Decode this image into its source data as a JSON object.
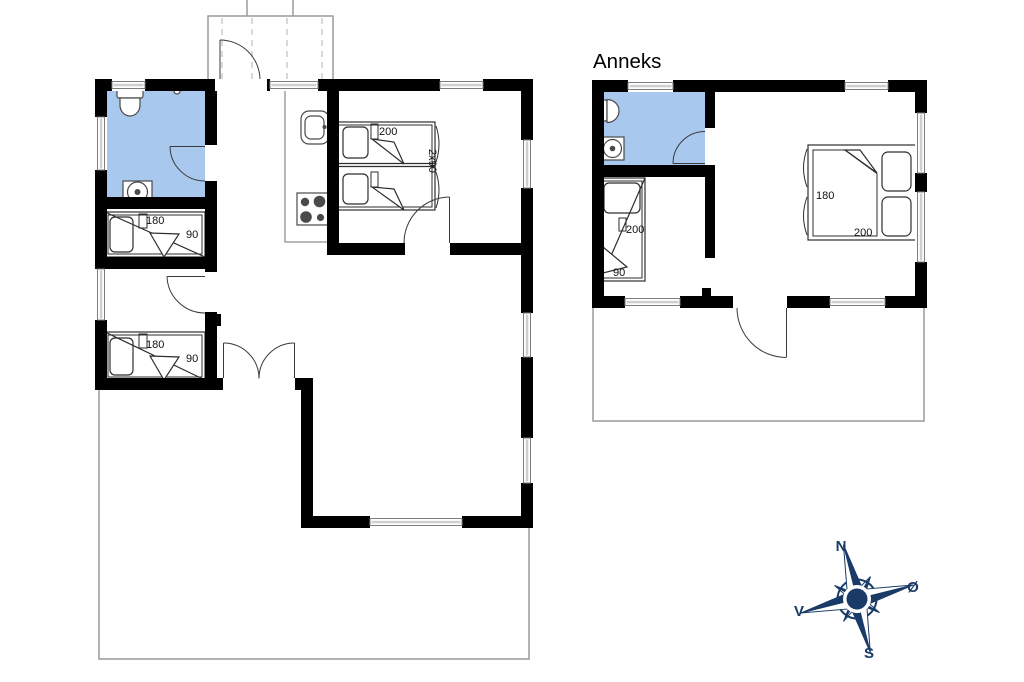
{
  "annex": {
    "name": "Anneks",
    "bunk_bed": {
      "length_label": "200",
      "width_label": "90"
    },
    "double_bed": {
      "width_label": "180",
      "length_label": "200"
    }
  },
  "main_house": {
    "bunk_room_top": {
      "length_label": "180",
      "width_label": "90"
    },
    "bunk_room_bottom": {
      "length_label": "180",
      "width_label": "90"
    },
    "double_bedroom": {
      "length_label": "200",
      "width_label": "2x90"
    }
  },
  "compass": {
    "north": "N",
    "east": "Ø",
    "south": "S",
    "west": "V"
  },
  "colors": {
    "bathroom": "#a9c8ee",
    "wall": "#000000",
    "compass": "#1a3a67",
    "terrace_outline": "#9a9a9a"
  }
}
